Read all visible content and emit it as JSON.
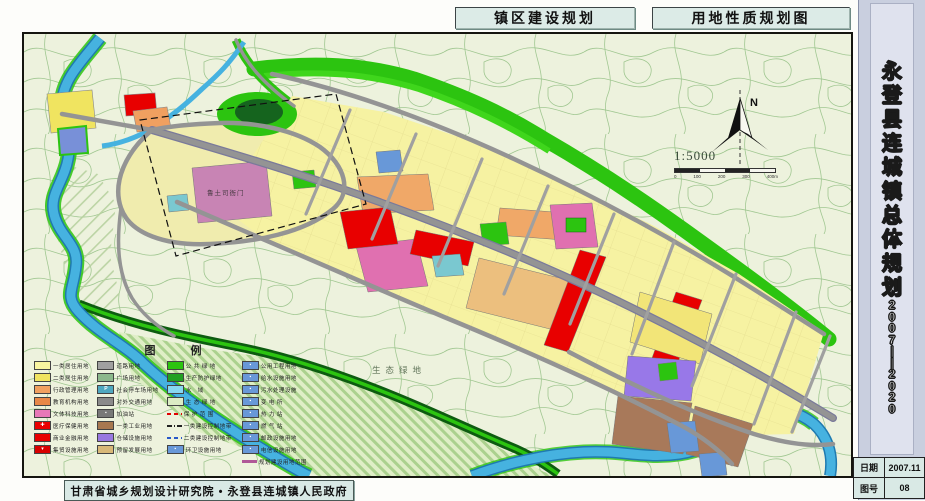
{
  "header": {
    "title_left": "镇区建设规划",
    "title_right": "用地性质规划图"
  },
  "sidebar": {
    "title": "永登县连城镇总体规划",
    "years": "2007——2020",
    "info": [
      {
        "label": "日期",
        "value": "2007.11"
      },
      {
        "label": "图号",
        "value": "08"
      }
    ]
  },
  "footer": {
    "credit": "甘肃省城乡规划设计研究院 • 永登县连城镇人民政府"
  },
  "map": {
    "north_label": "N",
    "scale_ratio": "1:5000",
    "scale_ticks": [
      "0",
      "100",
      "200",
      "300",
      "400m"
    ],
    "labels": {
      "heritage": "鲁土司衙门",
      "eco": "生态绿地"
    },
    "colors": {
      "water": "#46b2e0",
      "public_green": "#2cc410",
      "road": "#949494",
      "commercial_red": "#e80000",
      "residential_yellow": "#f6f2a2"
    }
  },
  "legend": {
    "title": "图  例",
    "columns": [
      {
        "items": [
          {
            "label": "一类居住用地",
            "color": "#f8f4a0",
            "type": "fill"
          },
          {
            "label": "二类居住用地",
            "color": "#f0e460",
            "type": "fill"
          },
          {
            "label": "行政管理用地",
            "color": "#f0a060",
            "type": "fill"
          },
          {
            "label": "教育机构用地",
            "color": "#e88848",
            "type": "fill"
          },
          {
            "label": "文体科技用地",
            "color": "#e878b8",
            "type": "fill"
          },
          {
            "label": "医疗保健用地",
            "color": "#e80000",
            "type": "fill",
            "icon": "✚"
          },
          {
            "label": "商业金融用地",
            "color": "#e80000",
            "type": "fill"
          },
          {
            "label": "集贸设施用地",
            "color": "#d80000",
            "type": "fill",
            "icon": "▾"
          }
        ]
      },
      {
        "items": [
          {
            "label": "道路用地",
            "color": "#a0a0a0",
            "type": "fill"
          },
          {
            "label": "广场用地",
            "color": "#8cb88c",
            "type": "fill"
          },
          {
            "label": "社会停车场用地",
            "color": "#50a8c0",
            "type": "fill",
            "icon": "P"
          },
          {
            "label": "对外交通用地",
            "color": "#8a8a8a",
            "type": "fill"
          },
          {
            "label": "加油站",
            "color": "#787878",
            "type": "fill",
            "icon": "▪"
          },
          {
            "label": "一类工业用地",
            "color": "#a87850",
            "type": "fill"
          },
          {
            "label": "仓储设施用地",
            "color": "#9878e0",
            "type": "fill"
          },
          {
            "label": "预留发展用地",
            "color": "#d8b878",
            "type": "fill"
          }
        ]
      },
      {
        "items": [
          {
            "label": "公 共 绿 地",
            "color": "#2cc410",
            "type": "fill"
          },
          {
            "label": "生产防护绿地",
            "color": "#22a022",
            "type": "fill"
          },
          {
            "label": "水　域",
            "color": "#88d8f0",
            "type": "fill"
          },
          {
            "label": "生 态 绿 地",
            "color": "#dcecc4",
            "type": "fill",
            "hatch": true
          },
          {
            "label": "保 护 范 围",
            "type": "line",
            "style": "red-dash"
          },
          {
            "label": "一类建设控制地带",
            "type": "line",
            "style": "dashdot"
          },
          {
            "label": "二类建设控制地带",
            "type": "line",
            "style": "blue-dash"
          },
          {
            "label": "环卫设施用地",
            "color": "#6898d8",
            "type": "fill",
            "icon": "▪"
          }
        ]
      },
      {
        "items": [
          {
            "label": "公用工程用地",
            "color": "#6898d8",
            "type": "fill",
            "icon": "▪"
          },
          {
            "label": "给水设施用地",
            "color": "#6898d8",
            "type": "fill",
            "icon": "▪"
          },
          {
            "label": "污水处理设施",
            "color": "#6898d8",
            "type": "fill",
            "icon": "▪"
          },
          {
            "label": "变 电 所",
            "color": "#6898d8",
            "type": "fill",
            "icon": "▪"
          },
          {
            "label": "热 力 站",
            "color": "#6898d8",
            "type": "fill",
            "icon": "▪"
          },
          {
            "label": "燃 气 站",
            "color": "#6898d8",
            "type": "fill",
            "icon": "▪"
          },
          {
            "label": "邮政设施用地",
            "color": "#6898d8",
            "type": "fill",
            "icon": "▪"
          },
          {
            "label": "电信设施用地",
            "color": "#6898d8",
            "type": "fill",
            "icon": "▪"
          },
          {
            "label": "规划建设用地范围",
            "type": "line",
            "style": "boundary"
          }
        ]
      }
    ]
  }
}
